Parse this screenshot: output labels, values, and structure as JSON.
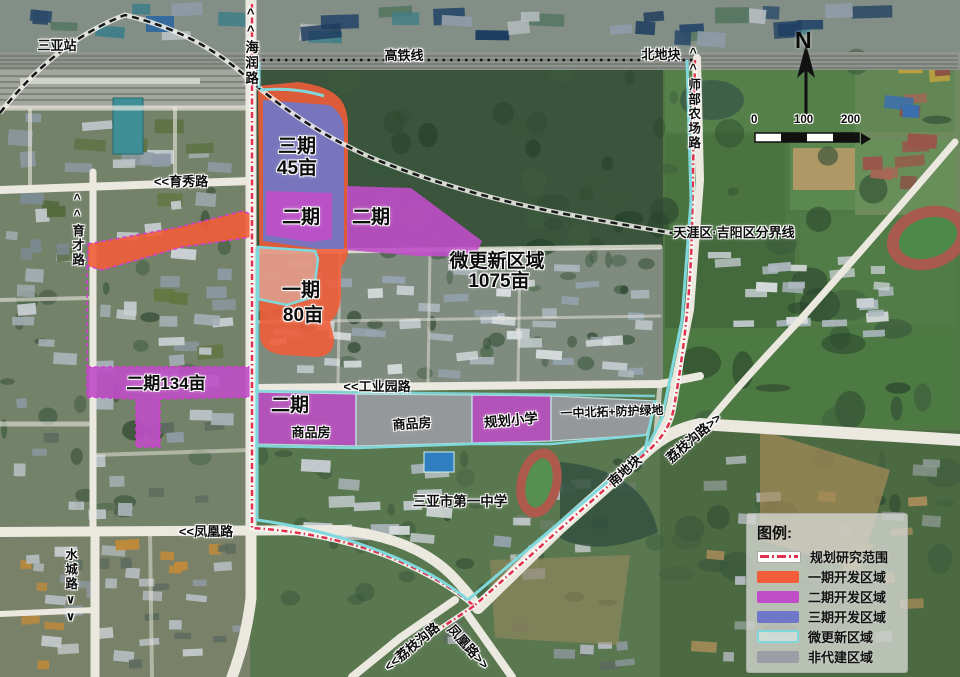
{
  "colors": {
    "research": "#e0304e",
    "phase1": "#f25c38",
    "phase2": "#c04ec8",
    "phase3": "#6f77c8",
    "micro": "#7fd8dc",
    "nonbuild": "#9d9da5"
  },
  "compass": {
    "label": "N"
  },
  "scalebar": {
    "ticks": [
      "0",
      "100",
      "200"
    ]
  },
  "labels": {
    "station": "三亚站",
    "hairun_road": "^^海润路",
    "gaotie_line": "高铁线",
    "north_plot": "北地块",
    "shibu_road": "^^师部农场路",
    "yuxiu_road": "<<育秀路",
    "yucai_road": "^^育才路",
    "district_boundary": "天涯区·吉阳区分界线",
    "micro_zone_line1": "微更新区域",
    "micro_zone_line2": "1075亩",
    "phase3_line1": "三期",
    "phase3_line2": "45亩",
    "phase2_left": "二期",
    "phase2_right": "二期",
    "phase1_line1": "一期",
    "phase1_line2": "80亩",
    "phase2_134": "二期134亩",
    "gongyeyuan_road": "<<工业园路",
    "band_phase2": "二期",
    "band_shangpin1": "商品房",
    "band_shangpin2": "商品房",
    "band_school": "规划小学",
    "band_green": "一中北拓+防护绿地",
    "no1_school": "三亚市第一中学",
    "south_plot": "南地块",
    "lizhigou_east": "荔枝沟路>>",
    "fenghuang_road": "<<凤凰路",
    "shuicheng_road": "水城路∨∨",
    "lizhigou_south": "<<荔枝沟路",
    "fenghuang_south": "凤凰路>>"
  },
  "legend": {
    "title": "图例:",
    "items": [
      {
        "label": "规划研究范围",
        "type": "research-line"
      },
      {
        "label": "一期开发区域",
        "type": "phase1"
      },
      {
        "label": "二期开发区域",
        "type": "phase2"
      },
      {
        "label": "三期开发区域",
        "type": "phase3"
      },
      {
        "label": "微更新区域",
        "type": "micro"
      },
      {
        "label": "非代建区域",
        "type": "nonbuild"
      }
    ]
  }
}
